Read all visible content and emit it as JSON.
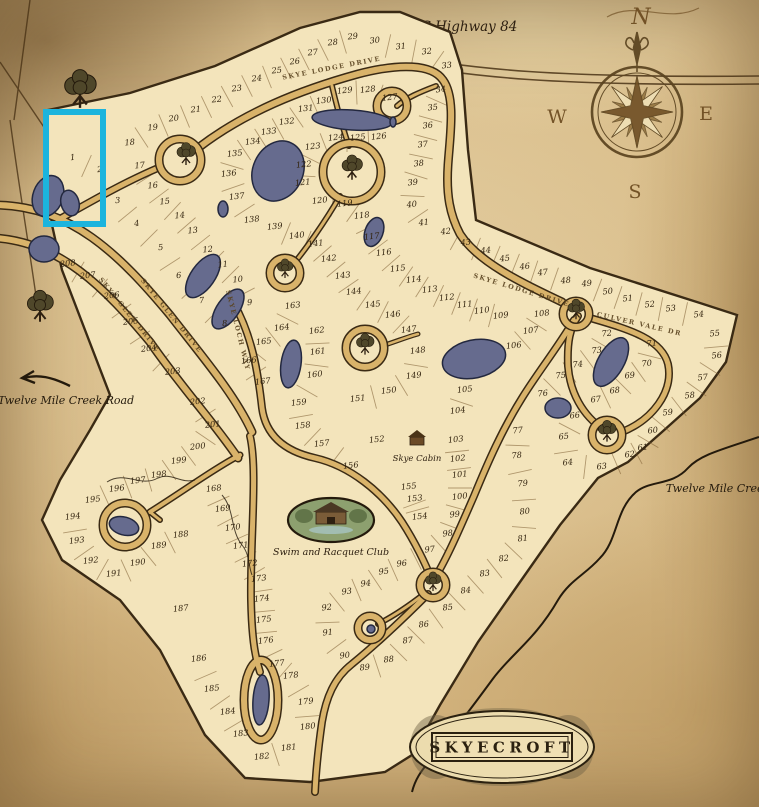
{
  "title": {
    "name": "SKYECROFT"
  },
  "labels": {
    "highway": "NC Highway 84",
    "creek_road": "Twelve Mile Creek Road",
    "creek": "Twelve Mile Creek",
    "cabin": "Skye Cabin",
    "club": "Swim and Racquet Club"
  },
  "compass": {
    "n": "N",
    "e": "E",
    "s": "S",
    "w": "W"
  },
  "colors": {
    "highlight": "#1cb4dd",
    "parchment": "#d8bd8c",
    "lot_fill": "#f3e4bb",
    "road_fill": "#d9b36a",
    "ink": "#33240f",
    "pond": "#666b8e"
  },
  "highlight": {
    "x": 46,
    "y": 112,
    "width": 57,
    "height": 112
  },
  "road_labels": [
    {
      "text": "SKYE LODGE DRIVE",
      "x": 332,
      "y": 70,
      "angle": -11
    },
    {
      "text": "SKYE LODGE DRIVE",
      "x": 521,
      "y": 292,
      "angle": 17
    },
    {
      "text": "CULVER VALE DR",
      "x": 639,
      "y": 326,
      "angle": 13
    },
    {
      "text": "SKYE GLEN DRIVE",
      "x": 128,
      "y": 316,
      "angle": 51
    },
    {
      "text": "SKYE GLEN DRIVE",
      "x": 170,
      "y": 317,
      "angle": 51
    },
    {
      "text": "SKYE LOCH WAY",
      "x": 236,
      "y": 331,
      "angle": 76
    }
  ],
  "lots": [
    [
      1,
      73,
      160
    ],
    [
      2,
      100,
      172
    ],
    [
      3,
      118,
      203
    ],
    [
      4,
      137,
      226
    ],
    [
      5,
      161,
      250
    ],
    [
      6,
      179,
      278
    ],
    [
      7,
      202,
      303
    ],
    [
      8,
      225,
      326
    ],
    [
      9,
      250,
      305
    ],
    [
      10,
      238,
      282
    ],
    [
      11,
      223,
      267
    ],
    [
      12,
      208,
      252
    ],
    [
      13,
      193,
      233
    ],
    [
      14,
      180,
      218
    ],
    [
      15,
      165,
      204
    ],
    [
      16,
      153,
      188
    ],
    [
      17,
      140,
      168
    ],
    [
      18,
      130,
      145
    ],
    [
      19,
      153,
      130
    ],
    [
      20,
      174,
      121
    ],
    [
      21,
      196,
      112
    ],
    [
      22,
      217,
      102
    ],
    [
      23,
      237,
      91
    ],
    [
      24,
      257,
      81
    ],
    [
      25,
      277,
      73
    ],
    [
      26,
      295,
      64
    ],
    [
      27,
      313,
      55
    ],
    [
      28,
      333,
      45
    ],
    [
      29,
      353,
      39
    ],
    [
      30,
      375,
      43
    ],
    [
      31,
      401,
      49
    ],
    [
      32,
      427,
      54
    ],
    [
      33,
      447,
      68
    ],
    [
      34,
      441,
      92
    ],
    [
      35,
      433,
      110
    ],
    [
      36,
      428,
      128
    ],
    [
      37,
      423,
      147
    ],
    [
      38,
      419,
      166
    ],
    [
      39,
      413,
      185
    ],
    [
      40,
      412,
      207
    ],
    [
      41,
      424,
      225
    ],
    [
      42,
      446,
      234
    ],
    [
      43,
      466,
      245
    ],
    [
      44,
      486,
      253
    ],
    [
      45,
      505,
      261
    ],
    [
      46,
      525,
      269
    ],
    [
      47,
      543,
      275
    ],
    [
      48,
      566,
      283
    ],
    [
      49,
      587,
      286
    ],
    [
      50,
      608,
      294
    ],
    [
      51,
      628,
      301
    ],
    [
      52,
      650,
      307
    ],
    [
      53,
      671,
      311
    ],
    [
      54,
      699,
      317
    ],
    [
      55,
      715,
      336
    ],
    [
      56,
      717,
      358
    ],
    [
      57,
      703,
      380
    ],
    [
      58,
      690,
      398
    ],
    [
      59,
      668,
      415
    ],
    [
      60,
      653,
      433
    ],
    [
      61,
      643,
      450
    ],
    [
      62,
      630,
      457
    ],
    [
      63,
      602,
      469
    ],
    [
      64,
      568,
      465
    ],
    [
      65,
      564,
      439
    ],
    [
      66,
      575,
      418
    ],
    [
      67,
      596,
      402
    ],
    [
      68,
      615,
      393
    ],
    [
      69,
      630,
      378
    ],
    [
      70,
      647,
      366
    ],
    [
      71,
      652,
      346
    ],
    [
      72,
      607,
      336
    ],
    [
      73,
      597,
      353
    ],
    [
      74,
      578,
      367
    ],
    [
      75,
      561,
      378
    ],
    [
      76,
      543,
      396
    ],
    [
      77,
      518,
      433
    ],
    [
      78,
      517,
      458
    ],
    [
      79,
      523,
      486
    ],
    [
      80,
      525,
      514
    ],
    [
      81,
      523,
      541
    ],
    [
      82,
      504,
      561
    ],
    [
      83,
      485,
      576
    ],
    [
      84,
      466,
      593
    ],
    [
      85,
      448,
      610
    ],
    [
      86,
      424,
      627
    ],
    [
      87,
      408,
      643
    ],
    [
      88,
      389,
      662
    ],
    [
      89,
      365,
      670
    ],
    [
      90,
      345,
      658
    ],
    [
      91,
      328,
      635
    ],
    [
      92,
      327,
      610
    ],
    [
      93,
      347,
      594
    ],
    [
      94,
      366,
      586
    ],
    [
      95,
      384,
      574
    ],
    [
      96,
      402,
      566
    ],
    [
      97,
      430,
      552
    ],
    [
      98,
      448,
      536
    ],
    [
      99,
      455,
      517
    ],
    [
      100,
      460,
      499
    ],
    [
      101,
      460,
      477
    ],
    [
      102,
      458,
      461
    ],
    [
      103,
      456,
      442
    ],
    [
      104,
      458,
      413
    ],
    [
      105,
      465,
      392
    ],
    [
      106,
      514,
      348
    ],
    [
      107,
      531,
      333
    ],
    [
      108,
      542,
      316
    ],
    [
      109,
      501,
      318
    ],
    [
      110,
      482,
      313
    ],
    [
      111,
      465,
      307
    ],
    [
      112,
      447,
      300
    ],
    [
      113,
      430,
      292
    ],
    [
      114,
      414,
      282
    ],
    [
      115,
      398,
      271
    ],
    [
      116,
      384,
      255
    ],
    [
      117,
      372,
      239
    ],
    [
      118,
      362,
      218
    ],
    [
      119,
      345,
      206
    ],
    [
      120,
      320,
      203
    ],
    [
      121,
      303,
      185
    ],
    [
      122,
      304,
      167
    ],
    [
      123,
      313,
      149
    ],
    [
      124,
      336,
      140
    ],
    [
      125,
      358,
      140
    ],
    [
      126,
      379,
      139
    ],
    [
      127,
      390,
      100
    ],
    [
      128,
      368,
      92
    ],
    [
      129,
      345,
      93
    ],
    [
      130,
      324,
      103
    ],
    [
      131,
      306,
      111
    ],
    [
      132,
      287,
      124
    ],
    [
      133,
      269,
      134
    ],
    [
      134,
      253,
      144
    ],
    [
      135,
      235,
      156
    ],
    [
      136,
      229,
      176
    ],
    [
      137,
      237,
      199
    ],
    [
      138,
      252,
      222
    ],
    [
      139,
      275,
      229
    ],
    [
      140,
      297,
      238
    ],
    [
      141,
      316,
      246
    ],
    [
      142,
      329,
      261
    ],
    [
      143,
      343,
      278
    ],
    [
      144,
      354,
      294
    ],
    [
      145,
      373,
      307
    ],
    [
      146,
      393,
      317
    ],
    [
      147,
      409,
      332
    ],
    [
      148,
      418,
      353
    ],
    [
      149,
      414,
      378
    ],
    [
      150,
      389,
      393
    ],
    [
      151,
      358,
      401
    ],
    [
      152,
      377,
      442
    ],
    [
      153,
      415,
      501
    ],
    [
      154,
      420,
      519
    ],
    [
      155,
      409,
      489
    ],
    [
      156,
      351,
      468
    ],
    [
      157,
      322,
      446
    ],
    [
      158,
      303,
      428
    ],
    [
      159,
      299,
      405
    ],
    [
      160,
      315,
      377
    ],
    [
      161,
      318,
      354
    ],
    [
      162,
      317,
      333
    ],
    [
      163,
      293,
      308
    ],
    [
      164,
      282,
      330
    ],
    [
      165,
      264,
      344
    ],
    [
      166,
      249,
      363
    ],
    [
      167,
      263,
      384
    ],
    [
      168,
      214,
      491
    ],
    [
      169,
      223,
      511
    ],
    [
      170,
      233,
      530
    ],
    [
      171,
      241,
      548
    ],
    [
      172,
      250,
      566
    ],
    [
      173,
      259,
      581
    ],
    [
      174,
      262,
      601
    ],
    [
      175,
      264,
      622
    ],
    [
      176,
      266,
      643
    ],
    [
      177,
      277,
      666
    ],
    [
      178,
      291,
      678
    ],
    [
      179,
      306,
      704
    ],
    [
      180,
      308,
      729
    ],
    [
      181,
      289,
      750
    ],
    [
      182,
      262,
      759
    ],
    [
      183,
      241,
      736
    ],
    [
      184,
      228,
      714
    ],
    [
      185,
      212,
      691
    ],
    [
      186,
      199,
      661
    ],
    [
      187,
      181,
      611
    ],
    [
      188,
      181,
      537
    ],
    [
      189,
      159,
      548
    ],
    [
      190,
      138,
      565
    ],
    [
      191,
      114,
      576
    ],
    [
      192,
      91,
      563
    ],
    [
      193,
      77,
      543
    ],
    [
      194,
      73,
      519
    ],
    [
      195,
      93,
      502
    ],
    [
      196,
      117,
      491
    ],
    [
      197,
      138,
      483
    ],
    [
      198,
      159,
      477
    ],
    [
      199,
      179,
      463
    ],
    [
      200,
      198,
      449
    ],
    [
      201,
      213,
      427
    ],
    [
      202,
      198,
      404
    ],
    [
      203,
      173,
      374
    ],
    [
      204,
      149,
      351
    ],
    [
      205,
      131,
      324
    ],
    [
      206,
      112,
      298
    ],
    [
      207,
      88,
      278
    ],
    [
      208,
      68,
      266
    ]
  ],
  "strips": [
    [
      1,
      2
    ],
    [
      3,
      4,
      5,
      6,
      7,
      8
    ],
    [
      9,
      10,
      11,
      12,
      13,
      14,
      15,
      16,
      17
    ],
    [
      18,
      19,
      20,
      21,
      22,
      23,
      24,
      25,
      26,
      27,
      28,
      29
    ],
    [
      30,
      31,
      32,
      33
    ],
    [
      34,
      35,
      36,
      37,
      38,
      39,
      40,
      41
    ],
    [
      42,
      43,
      44,
      45,
      46,
      47,
      48
    ],
    [
      49,
      50,
      51,
      52,
      53,
      54
    ],
    [
      55,
      56,
      57,
      58,
      59,
      60,
      61,
      62,
      63,
      64,
      65,
      66
    ],
    [
      67,
      68,
      69,
      70,
      71
    ],
    [
      72,
      73,
      74,
      75,
      76
    ],
    [
      77,
      78,
      79,
      80,
      81,
      82,
      83,
      84,
      85,
      86,
      87,
      88,
      89
    ],
    [
      90,
      91,
      92,
      93,
      94,
      95,
      96,
      97,
      98,
      99,
      100,
      101,
      102,
      103
    ],
    [
      104,
      105
    ],
    [
      106,
      107,
      108
    ],
    [
      109,
      110,
      111,
      112,
      113,
      114,
      115,
      116,
      117,
      118,
      119,
      120
    ],
    [
      121,
      122,
      123,
      124,
      125,
      126
    ],
    [
      127,
      128,
      129,
      130,
      131,
      132,
      133,
      134,
      135,
      136,
      137,
      138
    ],
    [
      139,
      140,
      141,
      142,
      143,
      144,
      145,
      146,
      147
    ],
    [
      148,
      149,
      150,
      151
    ],
    [
      153,
      154,
      155
    ],
    [
      156,
      157,
      158,
      159,
      160,
      161,
      162
    ],
    [
      163,
      164,
      165,
      166,
      167
    ],
    [
      168,
      169,
      170,
      171,
      172,
      173,
      174,
      175,
      176,
      177,
      178,
      179,
      180
    ],
    [
      181,
      182
    ],
    [
      183,
      184,
      185,
      186,
      187
    ],
    [
      188,
      189,
      190,
      191,
      192,
      193,
      194
    ],
    [
      195,
      196,
      197,
      198,
      199,
      200,
      201,
      202
    ],
    [
      203,
      204,
      205,
      206,
      207,
      208
    ]
  ],
  "ponds": [
    [
      48,
      196,
      15,
      21,
      20
    ],
    [
      70,
      203,
      9,
      13,
      -15
    ],
    [
      44,
      249,
      15,
      13,
      0
    ],
    [
      124,
      526,
      15,
      9,
      15
    ],
    [
      278,
      171,
      25,
      31,
      25
    ],
    [
      352,
      120,
      40,
      10,
      4
    ],
    [
      374,
      232,
      9,
      15,
      20
    ],
    [
      203,
      276,
      12,
      25,
      35
    ],
    [
      228,
      309,
      11,
      23,
      35
    ],
    [
      223,
      209,
      5,
      8,
      0
    ],
    [
      474,
      359,
      32,
      19,
      -12
    ],
    [
      611,
      362,
      13,
      27,
      30
    ],
    [
      291,
      364,
      10,
      24,
      8
    ],
    [
      558,
      408,
      13,
      10,
      0
    ],
    [
      261,
      700,
      8,
      25,
      4
    ],
    [
      371,
      629,
      4,
      4,
      0
    ],
    [
      393,
      122,
      3,
      5,
      0
    ]
  ],
  "trees": [
    [
      80,
      96,
      1.7
    ],
    [
      40,
      312,
      1.4
    ],
    [
      186,
      158,
      1.0
    ],
    [
      352,
      172,
      1.1
    ],
    [
      285,
      272,
      0.85
    ],
    [
      365,
      348,
      0.95
    ],
    [
      576,
      313,
      0.9
    ],
    [
      607,
      435,
      0.95
    ],
    [
      433,
      585,
      0.85
    ]
  ],
  "courts": [
    [
      180,
      160,
      21
    ],
    [
      352,
      172,
      29
    ],
    [
      285,
      273,
      15
    ],
    [
      365,
      348,
      19
    ],
    [
      576,
      314,
      13
    ],
    [
      607,
      435,
      15
    ],
    [
      433,
      585,
      13
    ],
    [
      392,
      106,
      15
    ],
    [
      125,
      525,
      22
    ],
    [
      370,
      628,
      12
    ]
  ]
}
